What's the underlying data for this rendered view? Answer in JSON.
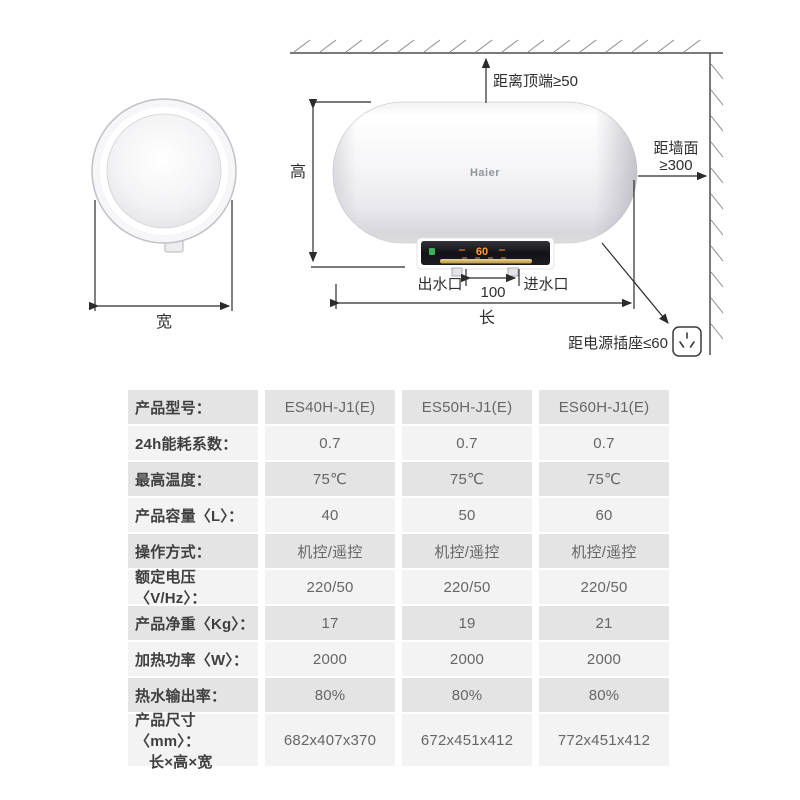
{
  "diagram": {
    "brand": "Haier",
    "display_value": "60",
    "labels": {
      "top_clearance": "距离顶端≥50",
      "wall_clearance_line1": "距墙面",
      "wall_clearance_line2": "≥300",
      "socket_clearance": "距电源插座≤60",
      "height": "高",
      "length": "长",
      "width": "宽",
      "outlet": "出水口",
      "inlet": "进水口",
      "pipe_spacing": "100"
    }
  },
  "colors": {
    "row_dark": "#e4e4e4",
    "row_light": "#f3f3f4",
    "line": "#333333",
    "gold_strip": "#d4ac62",
    "display_orange": "#ffa03a",
    "indicator_green": "#3fae5a"
  },
  "table": {
    "rows": [
      {
        "label": "产品型号：",
        "values": [
          "ES40H-J1(E)",
          "ES50H-J1(E)",
          "ES60H-J1(E)"
        ]
      },
      {
        "label": "24h能耗系数：",
        "values": [
          "0.7",
          "0.7",
          "0.7"
        ]
      },
      {
        "label": "最高温度：",
        "values": [
          "75℃",
          "75℃",
          "75℃"
        ]
      },
      {
        "label": "产品容量〈L〉：",
        "values": [
          "40",
          "50",
          "60"
        ]
      },
      {
        "label": "操作方式：",
        "values": [
          "机控/遥控",
          "机控/遥控",
          "机控/遥控"
        ]
      },
      {
        "label": "额定电压〈V/Hz〉：",
        "values": [
          "220/50",
          "220/50",
          "220/50"
        ]
      },
      {
        "label": "产品净重〈Kg〉：",
        "values": [
          "17",
          "19",
          "21"
        ]
      },
      {
        "label": "加热功率〈W〉：",
        "values": [
          "2000",
          "2000",
          "2000"
        ]
      },
      {
        "label": "热水输出率：",
        "values": [
          "80%",
          "80%",
          "80%"
        ]
      },
      {
        "label": "产品尺寸〈mm〉：",
        "label_line2": "长×高×宽",
        "values": [
          "682x407x370",
          "672x451x412",
          "772x451x412"
        ]
      }
    ]
  }
}
